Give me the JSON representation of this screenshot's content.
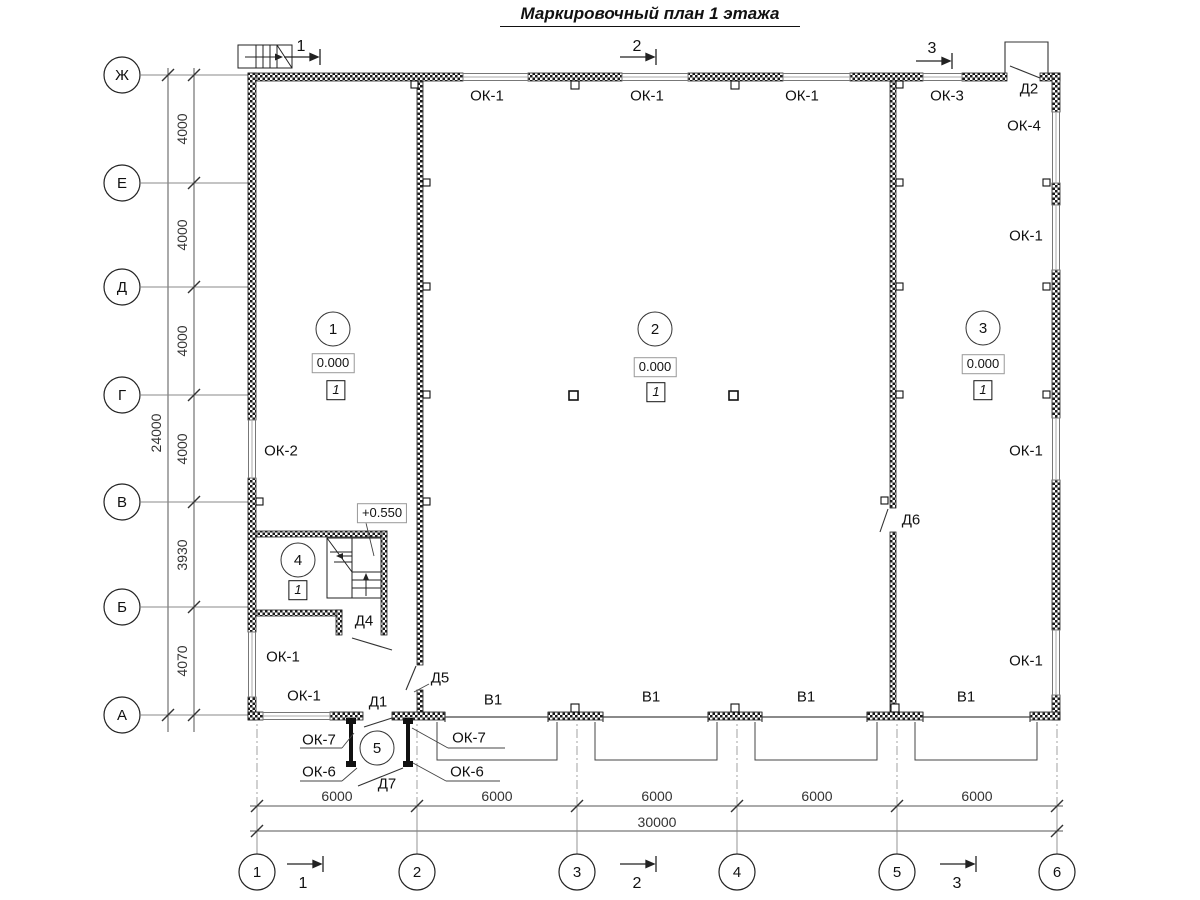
{
  "title": "Маркировочный план 1 этажа",
  "axes": {
    "rows": [
      "Ж",
      "Е",
      "Д",
      "Г",
      "В",
      "Б",
      "А"
    ],
    "cols": [
      "1",
      "2",
      "3",
      "4",
      "5",
      "6"
    ]
  },
  "dims": {
    "left": [
      "4000",
      "4000",
      "4000",
      "4000",
      "3930",
      "4070"
    ],
    "left_total": "24000",
    "bottom": [
      "6000",
      "6000",
      "6000",
      "6000",
      "6000"
    ],
    "bottom_total": "30000"
  },
  "sections": {
    "s1": "1",
    "s2": "2",
    "s3": "3"
  },
  "rooms": {
    "r1": "1",
    "r2": "2",
    "r3": "3",
    "r4": "4",
    "r5": "5"
  },
  "elevations": {
    "floor": "0.000",
    "stair_landing": "+0.550"
  },
  "finish_mark": "1",
  "marks": {
    "ok1": "ОК-1",
    "ok2": "ОК-2",
    "ok3": "ОК-3",
    "ok4": "ОК-4",
    "ok6": "ОК-6",
    "ok7": "ОК-7",
    "d1": "Д1",
    "d2": "Д2",
    "d4": "Д4",
    "d5": "Д5",
    "d6": "Д6",
    "d7": "Д7",
    "v1": "В1"
  }
}
